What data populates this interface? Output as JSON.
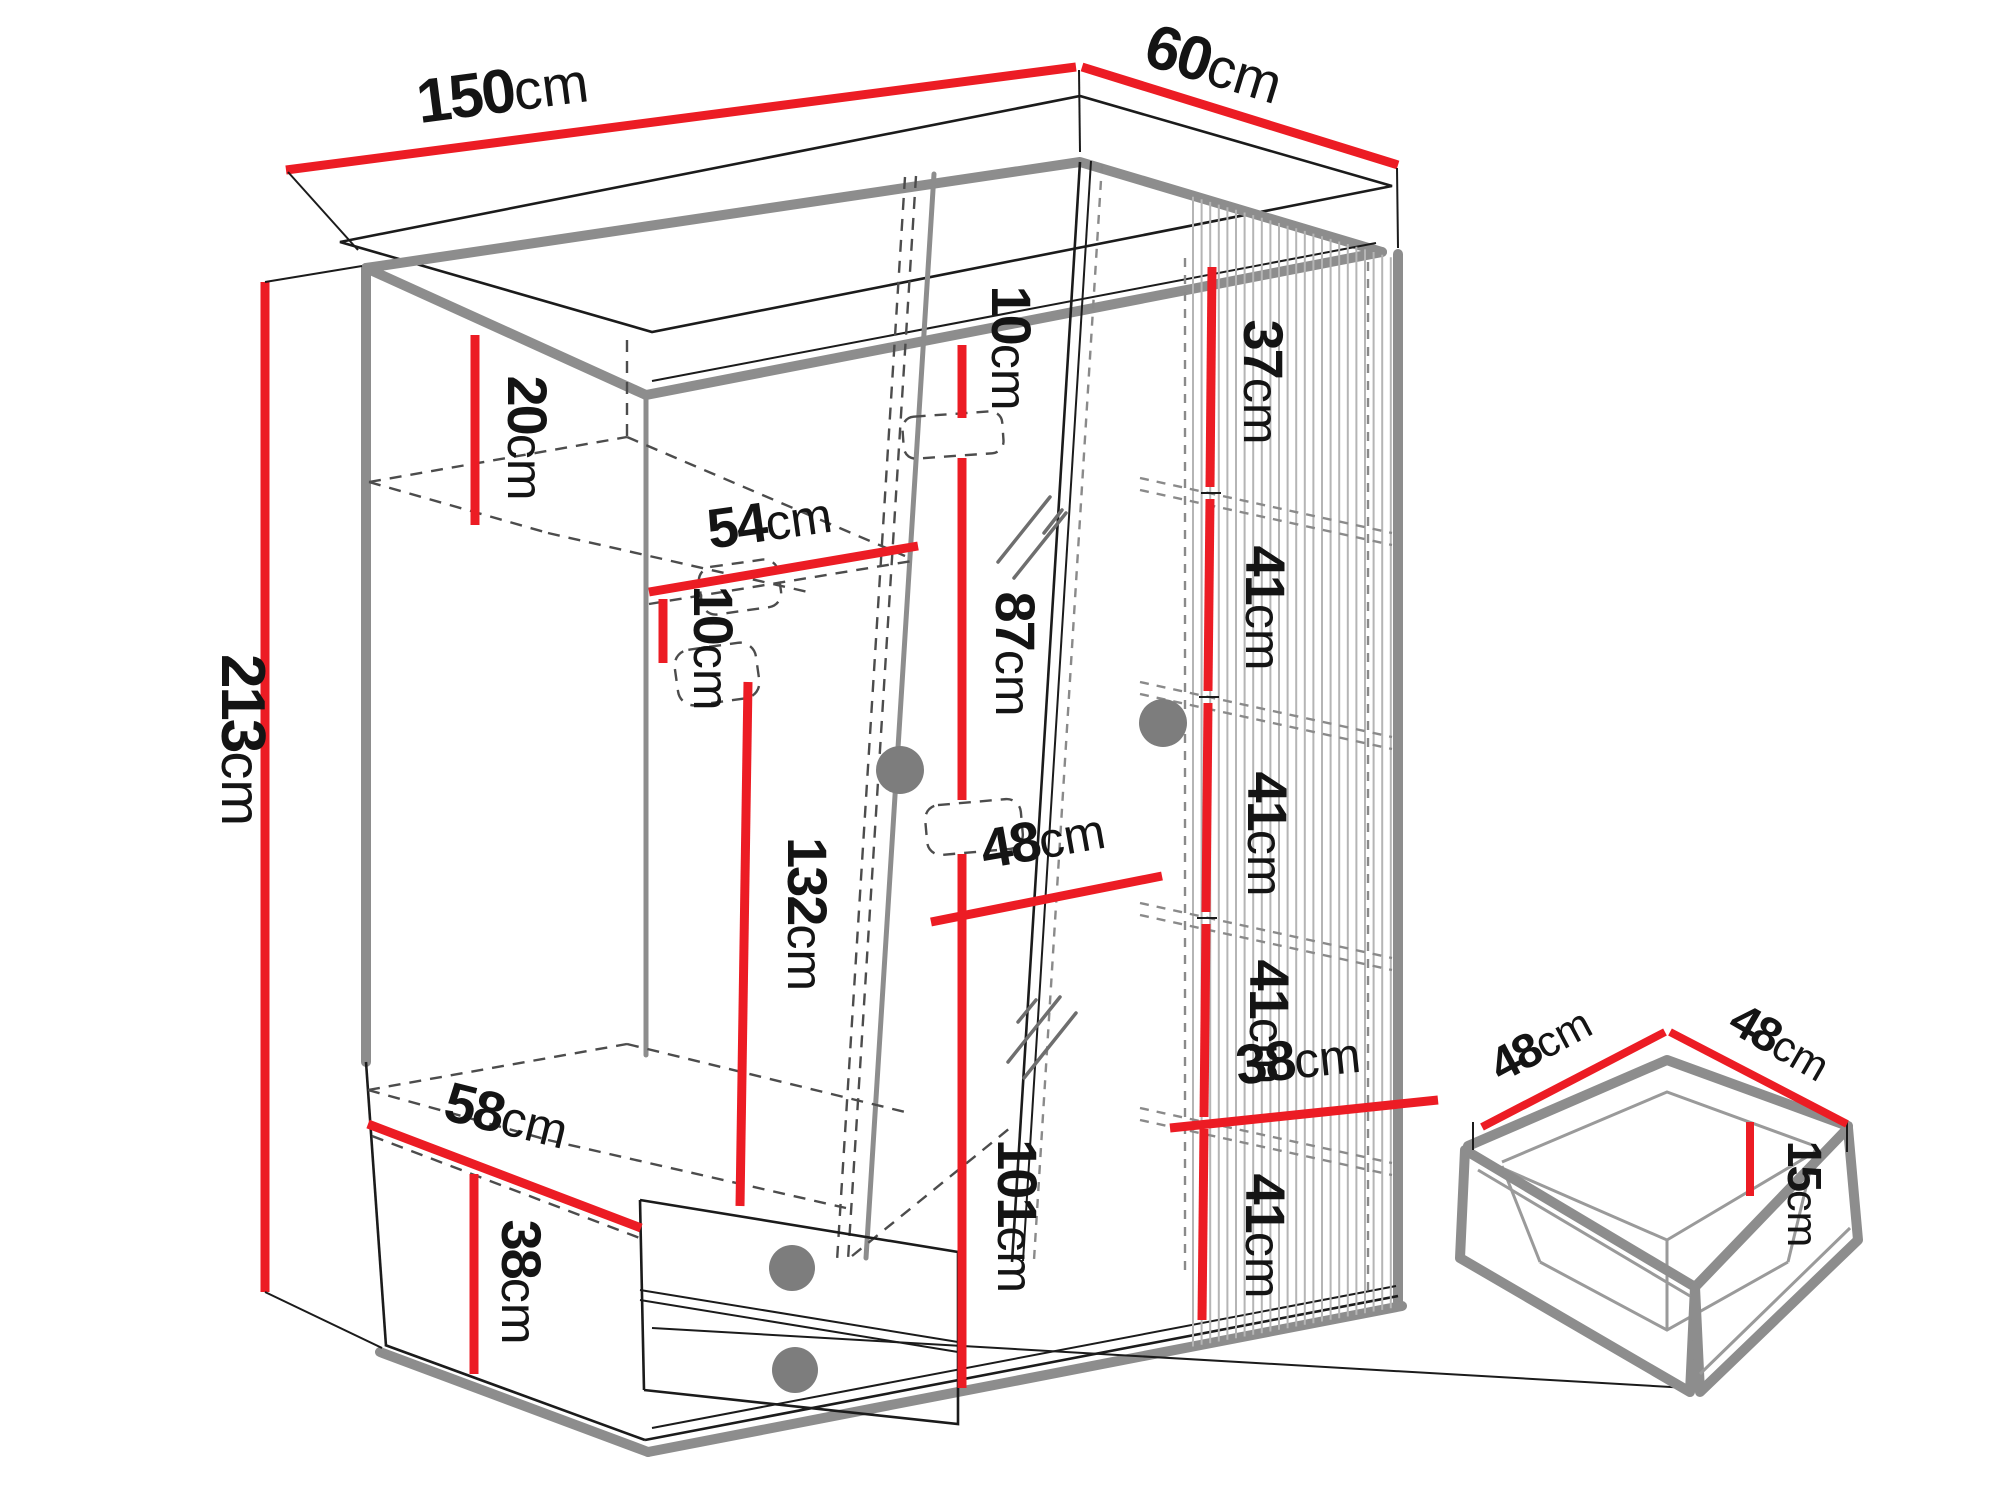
{
  "diagram": {
    "type": "furniture-dimension-drawing",
    "subject": "three-door wardrobe with mirror door, fluted side panel, interior shelves, hanging rail and two drawers; separate drawer-box detail",
    "unit": "cm",
    "colors": {
      "dimension_line": "#ec1c24",
      "outline_dark": "#1b1b1b",
      "outline_gray": "#8d8d8d",
      "dashed_line": "#4c4c4c",
      "label_text": "#141414",
      "background": "#ffffff"
    },
    "wardrobe": {
      "overall_width_cm": 150,
      "overall_depth_cm": 60,
      "overall_height_cm": 213,
      "top_shelf_drop_cm": 20,
      "left_section": {
        "inner_width_top_cm": 54,
        "rail_offset_cm": 10,
        "hanging_height_cm": 132,
        "inner_width_bottom_cm": 58,
        "drawer_section_height_cm": 38
      },
      "center_section": {
        "top_gap_cm": 10,
        "upper_mirror_height_cm": 87,
        "inner_width_cm": 48,
        "lower_mirror_height_cm": 101
      },
      "right_section": {
        "compartment_heights_cm": [
          37,
          41,
          41,
          41,
          41
        ],
        "inner_width_cm": 38
      }
    },
    "drawer_detail": {
      "width_cm": 48,
      "depth_cm": 48,
      "front_height_cm": 15
    }
  },
  "labels": {
    "d150": {
      "num": "150",
      "unit": "cm"
    },
    "d60": {
      "num": "60",
      "unit": "cm"
    },
    "d213": {
      "num": "213",
      "unit": "cm"
    },
    "d20": {
      "num": "20",
      "unit": "cm"
    },
    "d54": {
      "num": "54",
      "unit": "cm"
    },
    "d10l": {
      "num": "10",
      "unit": "cm"
    },
    "d132": {
      "num": "132",
      "unit": "cm"
    },
    "d10c": {
      "num": "10",
      "unit": "cm"
    },
    "d87": {
      "num": "87",
      "unit": "cm"
    },
    "d48c": {
      "num": "48",
      "unit": "cm"
    },
    "d101": {
      "num": "101",
      "unit": "cm"
    },
    "d58": {
      "num": "58",
      "unit": "cm"
    },
    "d38l": {
      "num": "38",
      "unit": "cm"
    },
    "d37": {
      "num": "37",
      "unit": "cm"
    },
    "d41a": {
      "num": "41",
      "unit": "cm"
    },
    "d41b": {
      "num": "41",
      "unit": "cm"
    },
    "d41c": {
      "num": "41",
      "unit": "cm"
    },
    "d41d": {
      "num": "41",
      "unit": "cm"
    },
    "d38r": {
      "num": "38",
      "unit": "cm"
    },
    "dd48a": {
      "num": "48",
      "unit": "cm"
    },
    "dd48b": {
      "num": "48",
      "unit": "cm"
    },
    "dd15": {
      "num": "15",
      "unit": "cm"
    }
  }
}
